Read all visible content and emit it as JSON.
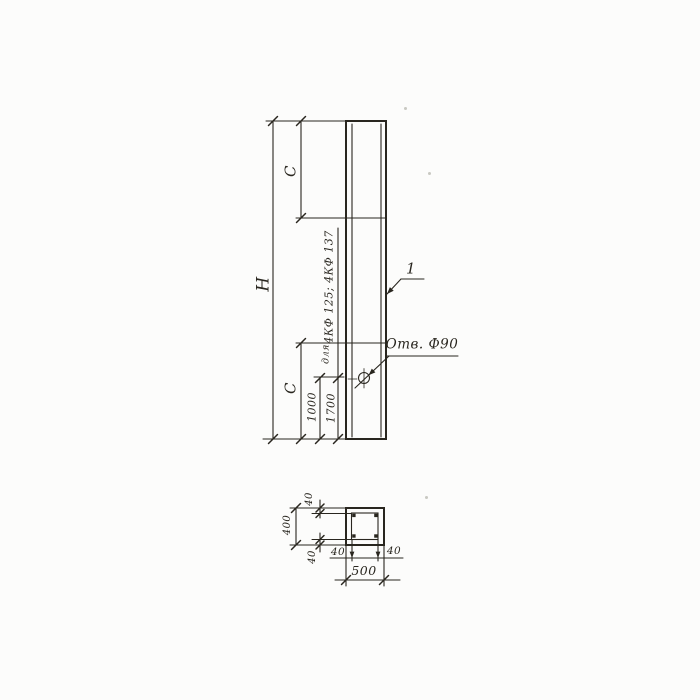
{
  "colors": {
    "ink": "#29261f",
    "paper": "#fcfcfb"
  },
  "elevation": {
    "overall_height_label": "H",
    "top_segment_label": "C",
    "bottom_segment_label": "C",
    "hole_offset_primary": "1000",
    "hole_offset_alt": "1700",
    "applicability_prefix": "для",
    "applicability_marks": "4КФ 125; 4КФ 137",
    "hole_callout": "Отв. Ф90",
    "part_mark": "1"
  },
  "section": {
    "overall_width": "500",
    "overall_height": "400",
    "cover_top": "40",
    "cover_bottom": "40",
    "cover_left": "40",
    "cover_right": "40"
  }
}
